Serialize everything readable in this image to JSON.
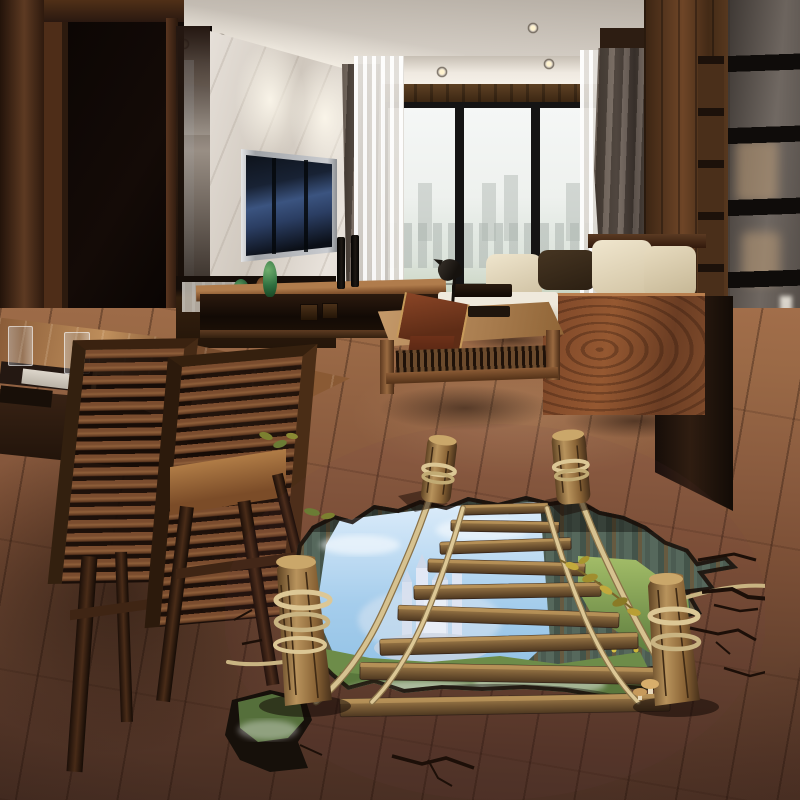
{
  "scene": {
    "type": "interior-photograph",
    "description": "Modern living room with dark wood paneling, wall TV, window city view, dining set, and a 3D trompe-l'oeil floor sticker of a rope bridge over a canyon landscape",
    "objects": [
      "ceiling-spotlights",
      "marble-tv-wall",
      "wall-tv",
      "tv-console",
      "green-vases",
      "window-city-view",
      "sheer-curtains",
      "dark-curtains",
      "wood-wall-panels",
      "glass-partition",
      "sofa-with-cushions",
      "wood-side-panel",
      "window-bench",
      "bird-sculpture",
      "coffee-table",
      "table-runner",
      "area-rug",
      "dining-table",
      "water-glasses",
      "slatted-chairs",
      "wood-plank-floor",
      "floor-sticker-hole",
      "rope-bridge",
      "wood-planks",
      "rope-rails",
      "log-posts",
      "castle",
      "sky-clouds",
      "green-valley",
      "cliff-walls",
      "floor-cracks",
      "mushrooms",
      "yellow-foliage"
    ]
  },
  "palette": {
    "ceiling_mid": "#d6cfc7",
    "marble": "#ded8d1",
    "door_dark": "#0e0805",
    "cabinet_wood": "#5d3a24",
    "window_frame": "#151414",
    "sky_view": "#f1f3f1",
    "greenery_view": "#9fae8d",
    "sheer": "#d9d5d0",
    "curtain": "#675c55",
    "right_wall": "#57371f",
    "partition": "#4b4543",
    "sofa_cream": "#e7dcc4",
    "pillow_dark": "#3a2c1e",
    "sofa_wood": "#7c4628",
    "bench_white": "#eae4d6",
    "rug": "#b3a78c",
    "floor_mid": "#9a6847",
    "floor_fore": "#462d22",
    "hole_rim": "#1a0f09",
    "cliff_green": "#5a6c60",
    "sky_hole": "#8fc0e4",
    "castle": "#e2e7f3",
    "grass": "#6d8c49",
    "plank": "#8a6a42",
    "rope": "#d6c290",
    "log": "#b08c55",
    "mist": "#ffffff"
  }
}
